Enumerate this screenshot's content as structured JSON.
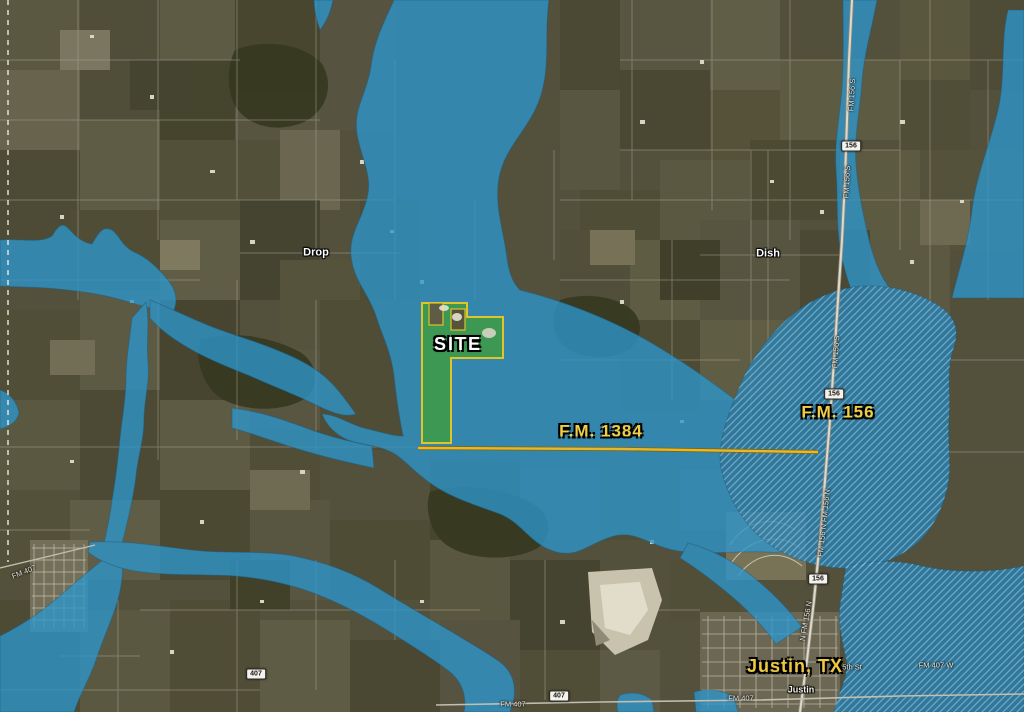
{
  "map": {
    "colors": {
      "flood_zone_blue": "#2D96CC",
      "floodway_blue": "#2A82B4",
      "site_green": "#3E9C3C",
      "site_border_yellow": "#E0C428",
      "road_yellow": "#E8B82A",
      "label_yellow": "#EECF45",
      "label_white": "#FFFFFF",
      "terrain_olive": "#53513B"
    },
    "site": {
      "label": "SITE"
    },
    "labels": [
      {
        "id": "site-label",
        "text": "SITE",
        "x": 458,
        "y": 344,
        "style": "site",
        "rot": 0
      },
      {
        "id": "fm-1384-label",
        "text": "F.M. 1384",
        "x": 601,
        "y": 431,
        "style": "road-major",
        "rot": 0
      },
      {
        "id": "fm-156-label",
        "text": "F.M. 156",
        "x": 838,
        "y": 412,
        "style": "road-major",
        "rot": 0
      },
      {
        "id": "justin-tx-label",
        "text": "Justin, TX",
        "x": 795,
        "y": 666,
        "style": "city-major",
        "rot": 0
      },
      {
        "id": "town-drop-label",
        "text": "Drop",
        "x": 316,
        "y": 253,
        "style": "town",
        "rot": 0
      },
      {
        "id": "town-dish-label",
        "text": "Dish",
        "x": 768,
        "y": 254,
        "style": "town",
        "rot": 0
      },
      {
        "id": "justin-town-label",
        "text": "Justin",
        "x": 801,
        "y": 690,
        "style": "town-small",
        "rot": 0
      },
      {
        "id": "fifth-st-label",
        "text": "5th St",
        "x": 852,
        "y": 667,
        "style": "minor",
        "rot": 0
      },
      {
        "id": "fm-407-w-label",
        "text": "FM 407 W",
        "x": 936,
        "y": 665,
        "style": "minor",
        "rot": 0
      },
      {
        "id": "fm-407-se-label",
        "text": "FM 407",
        "x": 741,
        "y": 698,
        "style": "minor",
        "rot": 0
      },
      {
        "id": "fm-407-s-label",
        "text": "FM 407",
        "x": 513,
        "y": 704,
        "style": "minor",
        "rot": 0
      },
      {
        "id": "fm-407-nw-label",
        "text": "FM 407",
        "x": 24,
        "y": 572,
        "style": "minor",
        "rot": -22
      },
      {
        "id": "fm-156-s-label-1",
        "text": "FM 156 S",
        "x": 852,
        "y": 95,
        "style": "minor",
        "rot": -87
      },
      {
        "id": "fm-156-s-label-2",
        "text": "FM 156 S",
        "x": 847,
        "y": 182,
        "style": "minor",
        "rot": -87
      },
      {
        "id": "fm-156-s-label-3",
        "text": "FM 156 S",
        "x": 836,
        "y": 352,
        "style": "minor",
        "rot": -86
      },
      {
        "id": "fm-156-n-label-1",
        "text": "FM 156 N FM 156 N",
        "x": 824,
        "y": 523,
        "style": "minor",
        "rot": -84
      },
      {
        "id": "fm-156-n-label-2",
        "text": "N FM 156 N",
        "x": 806,
        "y": 621,
        "style": "minor",
        "rot": -80
      }
    ],
    "shields": [
      {
        "id": "route-shield-156-north",
        "text": "156",
        "x": 851,
        "y": 146
      },
      {
        "id": "route-shield-156-middle",
        "text": "156",
        "x": 834,
        "y": 394
      },
      {
        "id": "route-shield-156-south",
        "text": "156",
        "x": 818,
        "y": 579
      },
      {
        "id": "route-shield-407-west",
        "text": "407",
        "x": 256,
        "y": 674
      },
      {
        "id": "route-shield-407-center",
        "text": "407",
        "x": 559,
        "y": 696
      }
    ]
  }
}
